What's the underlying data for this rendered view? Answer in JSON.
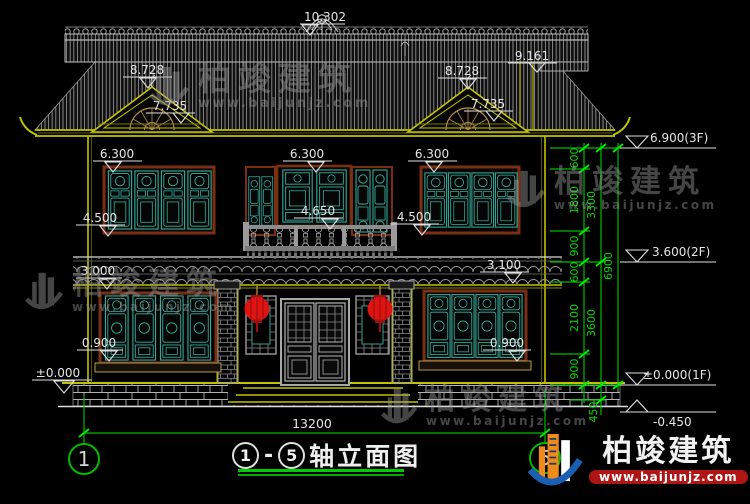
{
  "brand": {
    "name": "柏竣建筑",
    "url": "www.baijunjz.com"
  },
  "drawing_title": {
    "axis_from": "1",
    "separator": "-",
    "axis_to": "5",
    "label": "轴立面图"
  },
  "axis_bubbles": {
    "left": "1",
    "right": "5"
  },
  "elevations": {
    "ridge": "10.302",
    "right_eave": "9.161",
    "gable_left_upper": "8.728",
    "gable_left_lower": "7.735",
    "gable_right_upper": "8.728",
    "gable_right_lower": "7.735",
    "f2_left_head": "6.300",
    "f2_center_head": "6.300",
    "f2_right_head": "6.300",
    "f2_left_sill": "4.500",
    "f2_balcony": "4.650",
    "f2_right_sill": "4.500",
    "f1_left_head": "3.000",
    "f1_left_sill": "0.900",
    "f1_right_head": "3.100",
    "f1_right_sill": "0.900",
    "ground_left": "±0.000",
    "level_3f": "6.900(3F)",
    "level_2f": "3.600(2F)",
    "level_1f": "±0.000(1F)",
    "level_below": "-0.450"
  },
  "dimensions": {
    "total_width": "13200",
    "inner_chain": [
      "600",
      "1800",
      "900",
      "600",
      "2100",
      "900"
    ],
    "mid_chain": [
      "3300",
      "3600",
      "450"
    ],
    "overall_height": "6900"
  },
  "colors": {
    "dim_green": "#00cc00",
    "eave_yellow": "#c2c200",
    "lattice_teal": "#36b3a3",
    "frame_brown": "#7a2e12",
    "lantern_red": "#e01313"
  }
}
